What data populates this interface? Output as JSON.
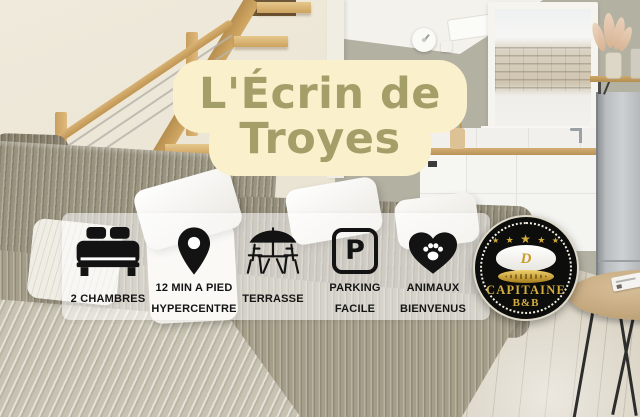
{
  "colors": {
    "banner-bg": "#faf0cc",
    "title-text": "#a49e69",
    "band-bg": "rgba(255,255,255,0.55)",
    "feature-text": "#141414",
    "icon-black": "#131313",
    "badge-bg": "#0d0d0c",
    "badge-gold": "#d3ae3f",
    "badge-ring": "#f1eee1"
  },
  "title_banner": {
    "line1": "L'Écrin de",
    "line2": "Troyes"
  },
  "features": [
    {
      "name": "bedrooms",
      "icon": "bed-icon",
      "lines": [
        "2 CHAMBRES"
      ]
    },
    {
      "name": "walk-distance",
      "icon": "location-pin-icon",
      "lines": [
        "12 MIN A PIED",
        "HYPERCENTRE"
      ]
    },
    {
      "name": "terrace",
      "icon": "terrace-icon",
      "lines": [
        "TERRASSE"
      ]
    },
    {
      "name": "parking",
      "icon": "parking-icon",
      "letter": "P",
      "lines": [
        "PARKING",
        "FACILE"
      ]
    },
    {
      "name": "pets",
      "icon": "heart-paw-icon",
      "lines": [
        "ANIMAUX",
        "BIENVENUS"
      ]
    }
  ],
  "badge": {
    "stars": [
      "★",
      "★",
      "★",
      "★",
      "★"
    ],
    "emblem": "D",
    "name_top": "CAPITAINE",
    "name_bottom": "B&B"
  }
}
